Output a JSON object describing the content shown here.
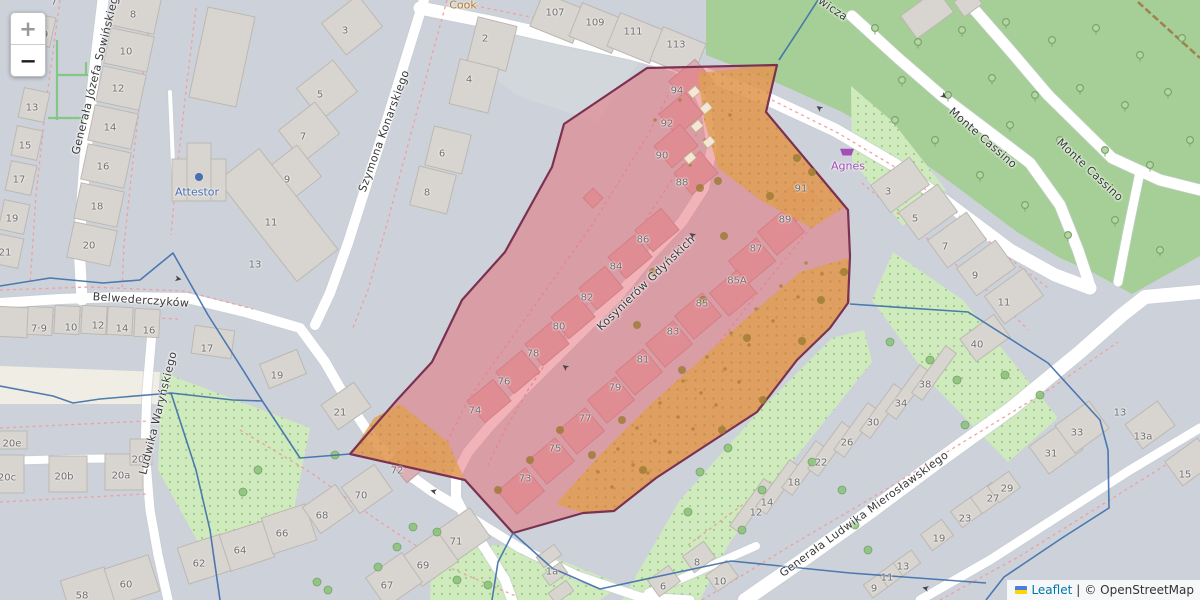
{
  "controls": {
    "zoom_in_label": "+",
    "zoom_out_label": "−"
  },
  "attribution": {
    "flag": "ukraine-flag",
    "leaflet_link": "Leaflet",
    "separator": "|",
    "copyright_link": "© OpenStreetMap"
  },
  "colors": {
    "base": "#cdd2da",
    "park_green": "#a5cf96",
    "dotted_green": "#cfeabd",
    "highlight_red_fill": "#e66771",
    "highlight_red_outline": "#7b3150",
    "highlight_orange_fill": "#dfa050",
    "boundary_blue": "#3d6ea8",
    "parcel_dash_red": "#f09c9c",
    "road_white": "#ffffff",
    "poi_blue": "#4a6fb0",
    "poi_purple": "#a44fb8",
    "poi_orange": "#b07a25"
  },
  "streets": [
    {
      "name": "Generała Józefa Sowińskiego",
      "x": 96,
      "y": 72,
      "rot": -76
    },
    {
      "name": "Szymona Konarskiego",
      "x": 384,
      "y": 131,
      "rot": -70
    },
    {
      "name": "Kosynierów Gdyńskich",
      "x": 646,
      "y": 283,
      "rot": -44
    },
    {
      "name": "Belwederczyków",
      "x": 141,
      "y": 300,
      "rot": 4
    },
    {
      "name": "Ludwika Waryńskiego",
      "x": 158,
      "y": 413,
      "rot": -76
    },
    {
      "name": "Monte Cassino",
      "x": 983,
      "y": 138,
      "rot": 41
    },
    {
      "name": "Monte Cassino",
      "x": 1090,
      "y": 170,
      "rot": 43
    },
    {
      "name": "Generała Ludwika Mierosławskiego",
      "x": 864,
      "y": 514,
      "rot": -36
    },
    {
      "name": "wicza",
      "x": 833,
      "y": 9,
      "rot": 34
    }
  ],
  "pois": [
    {
      "name": "Attestor",
      "x": 197,
      "y": 192,
      "color": "#4a6fb0",
      "icon": "dot-icon",
      "icon_x": 199,
      "icon_y": 177
    },
    {
      "name": "Agnes",
      "x": 848,
      "y": 166,
      "color": "#a44fb8",
      "icon": "basket-icon",
      "icon_x": 847,
      "icon_y": 151
    },
    {
      "name": "Cook",
      "x": 463,
      "y": 5,
      "color": "#b07a25",
      "icon": "",
      "icon_x": 0,
      "icon_y": 0
    }
  ],
  "house_numbers": [
    {
      "t": "7",
      "x": 54,
      "y": 2
    },
    {
      "t": "8",
      "x": 133,
      "y": 15
    },
    {
      "t": "9",
      "x": 45,
      "y": 35
    },
    {
      "t": "10",
      "x": 126,
      "y": 52
    },
    {
      "t": "12",
      "x": 118,
      "y": 89
    },
    {
      "t": "13",
      "x": 32,
      "y": 108
    },
    {
      "t": "14",
      "x": 110,
      "y": 128
    },
    {
      "t": "15",
      "x": 25,
      "y": 146
    },
    {
      "t": "16",
      "x": 103,
      "y": 167
    },
    {
      "t": "17",
      "x": 19,
      "y": 180
    },
    {
      "t": "18",
      "x": 97,
      "y": 207
    },
    {
      "t": "19",
      "x": 12,
      "y": 219
    },
    {
      "t": "20",
      "x": 89,
      "y": 246
    },
    {
      "t": "21",
      "x": 5,
      "y": 253
    },
    {
      "t": "3",
      "x": 345,
      "y": 31
    },
    {
      "t": "5",
      "x": 320,
      "y": 95
    },
    {
      "t": "7",
      "x": 303,
      "y": 137
    },
    {
      "t": "9",
      "x": 287,
      "y": 180
    },
    {
      "t": "11",
      "x": 271,
      "y": 223
    },
    {
      "t": "13",
      "x": 255,
      "y": 265
    },
    {
      "t": "2",
      "x": 485,
      "y": 39
    },
    {
      "t": "4",
      "x": 469,
      "y": 80
    },
    {
      "t": "6",
      "x": 442,
      "y": 154
    },
    {
      "t": "8",
      "x": 427,
      "y": 193
    },
    {
      "t": "107",
      "x": 555,
      "y": 13
    },
    {
      "t": "109",
      "x": 595,
      "y": 23
    },
    {
      "t": "111",
      "x": 633,
      "y": 32
    },
    {
      "t": "113",
      "x": 676,
      "y": 45
    },
    {
      "t": "94",
      "x": 677,
      "y": 91
    },
    {
      "t": "92",
      "x": 667,
      "y": 124
    },
    {
      "t": "90",
      "x": 662,
      "y": 156
    },
    {
      "t": "88",
      "x": 682,
      "y": 183
    },
    {
      "t": "86",
      "x": 643,
      "y": 240
    },
    {
      "t": "84",
      "x": 616,
      "y": 267
    },
    {
      "t": "82",
      "x": 587,
      "y": 298
    },
    {
      "t": "80",
      "x": 559,
      "y": 327
    },
    {
      "t": "78",
      "x": 533,
      "y": 354
    },
    {
      "t": "76",
      "x": 504,
      "y": 382
    },
    {
      "t": "74",
      "x": 475,
      "y": 411
    },
    {
      "t": "72",
      "x": 397,
      "y": 471
    },
    {
      "t": "91",
      "x": 801,
      "y": 189
    },
    {
      "t": "89",
      "x": 785,
      "y": 220
    },
    {
      "t": "87",
      "x": 756,
      "y": 249
    },
    {
      "t": "85A",
      "x": 737,
      "y": 281
    },
    {
      "t": "85",
      "x": 702,
      "y": 304
    },
    {
      "t": "83",
      "x": 673,
      "y": 332
    },
    {
      "t": "81",
      "x": 643,
      "y": 360
    },
    {
      "t": "79",
      "x": 615,
      "y": 388
    },
    {
      "t": "77",
      "x": 585,
      "y": 419
    },
    {
      "t": "75",
      "x": 555,
      "y": 449
    },
    {
      "t": "73",
      "x": 525,
      "y": 479
    },
    {
      "t": "3",
      "x": 888,
      "y": 192
    },
    {
      "t": "5",
      "x": 915,
      "y": 219
    },
    {
      "t": "7",
      "x": 945,
      "y": 247
    },
    {
      "t": "9",
      "x": 975,
      "y": 276
    },
    {
      "t": "11",
      "x": 1004,
      "y": 303
    },
    {
      "t": "40",
      "x": 977,
      "y": 345
    },
    {
      "t": "13",
      "x": 1120,
      "y": 413
    },
    {
      "t": "13a",
      "x": 1143,
      "y": 437
    },
    {
      "t": "15",
      "x": 1185,
      "y": 475
    },
    {
      "t": "7·9",
      "x": 39,
      "y": 329
    },
    {
      "t": "10",
      "x": 71,
      "y": 328
    },
    {
      "t": "12",
      "x": 98,
      "y": 326
    },
    {
      "t": "14",
      "x": 122,
      "y": 329
    },
    {
      "t": "16",
      "x": 149,
      "y": 331
    },
    {
      "t": "17",
      "x": 207,
      "y": 349
    },
    {
      "t": "19",
      "x": 277,
      "y": 376
    },
    {
      "t": "20e",
      "x": 12,
      "y": 444
    },
    {
      "t": "20c",
      "x": 7,
      "y": 478
    },
    {
      "t": "20b",
      "x": 64,
      "y": 477
    },
    {
      "t": "20a",
      "x": 121,
      "y": 476
    },
    {
      "t": "20",
      "x": 138,
      "y": 460
    },
    {
      "t": "58",
      "x": 82,
      "y": 596
    },
    {
      "t": "60",
      "x": 126,
      "y": 585
    },
    {
      "t": "62",
      "x": 199,
      "y": 564
    },
    {
      "t": "64",
      "x": 240,
      "y": 551
    },
    {
      "t": "66",
      "x": 282,
      "y": 534
    },
    {
      "t": "21",
      "x": 340,
      "y": 413
    },
    {
      "t": "68",
      "x": 322,
      "y": 516
    },
    {
      "t": "70",
      "x": 361,
      "y": 496
    },
    {
      "t": "71",
      "x": 456,
      "y": 542
    },
    {
      "t": "69",
      "x": 423,
      "y": 566
    },
    {
      "t": "67",
      "x": 387,
      "y": 586
    },
    {
      "t": "1a",
      "x": 552,
      "y": 572
    },
    {
      "t": "12",
      "x": 756,
      "y": 513
    },
    {
      "t": "14",
      "x": 767,
      "y": 503
    },
    {
      "t": "18",
      "x": 794,
      "y": 483
    },
    {
      "t": "22",
      "x": 821,
      "y": 463
    },
    {
      "t": "26",
      "x": 847,
      "y": 443
    },
    {
      "t": "30",
      "x": 873,
      "y": 423
    },
    {
      "t": "34",
      "x": 901,
      "y": 404
    },
    {
      "t": "38",
      "x": 925,
      "y": 385
    },
    {
      "t": "6",
      "x": 663,
      "y": 587
    },
    {
      "t": "8",
      "x": 697,
      "y": 563
    },
    {
      "t": "10",
      "x": 720,
      "y": 582
    },
    {
      "t": "9",
      "x": 874,
      "y": 589
    },
    {
      "t": "11",
      "x": 887,
      "y": 578
    },
    {
      "t": "13",
      "x": 903,
      "y": 567
    },
    {
      "t": "19",
      "x": 939,
      "y": 539
    },
    {
      "t": "23",
      "x": 965,
      "y": 519
    },
    {
      "t": "27",
      "x": 993,
      "y": 499
    },
    {
      "t": "29",
      "x": 1007,
      "y": 489
    },
    {
      "t": "31",
      "x": 1051,
      "y": 454
    },
    {
      "t": "33",
      "x": 1077,
      "y": 433
    }
  ],
  "oneway_arrows": [
    {
      "x": 943,
      "y": 97,
      "rot": 38
    },
    {
      "x": 820,
      "y": 107,
      "rot": 215
    },
    {
      "x": 693,
      "y": 234,
      "rot": 215
    },
    {
      "x": 566,
      "y": 366,
      "rot": 215
    },
    {
      "x": 434,
      "y": 490,
      "rot": 195
    },
    {
      "x": 926,
      "y": 587,
      "rot": 195
    },
    {
      "x": 178,
      "y": 280,
      "rot": 10
    }
  ]
}
